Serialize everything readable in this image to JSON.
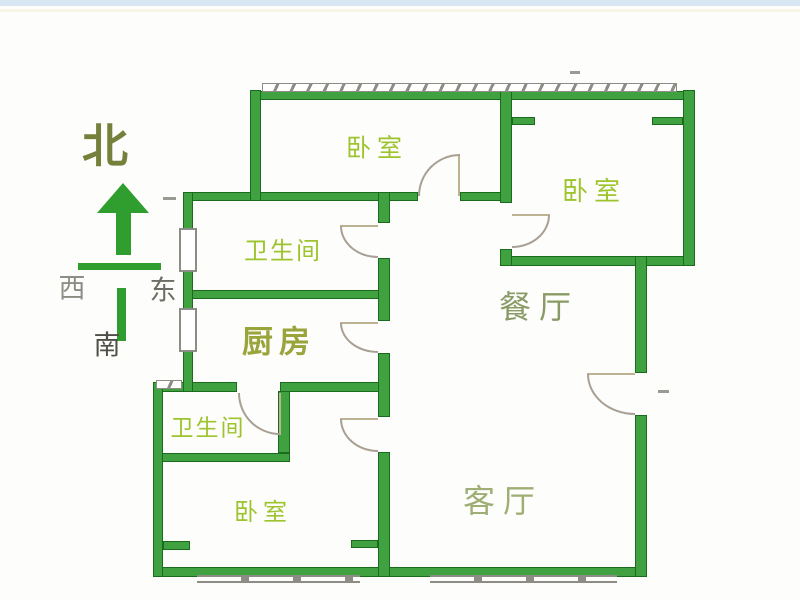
{
  "compass": {
    "north": "北",
    "west": "西",
    "east": "东",
    "south": "南"
  },
  "rooms": {
    "bedroom_top": {
      "label": "卧室"
    },
    "bedroom_right": {
      "label": "卧室"
    },
    "bedroom_bottom": {
      "label": "卧室"
    },
    "bathroom_upper": {
      "label": "卫生间"
    },
    "bathroom_lower": {
      "label": "卫生间"
    },
    "kitchen": {
      "label": "厨房"
    },
    "dining": {
      "label": "餐厅"
    },
    "living": {
      "label": "客厅"
    }
  },
  "colors": {
    "wall_green": "#3fa13f",
    "wall_border": "#1a6b1d",
    "door_leaf_tan": "#bdb292",
    "door_arc_gray": "#a8a094",
    "window_gray": "#8d8d85",
    "compass_arrow_green": "#2f9e2f",
    "label_bright_green": "#9dc42e",
    "label_olive": "#99a43b",
    "label_sage": "#8a9a66",
    "label_sage_light": "#9fae74",
    "north_olive": "#75803b",
    "west_gray": "#8d8d86",
    "east_gray": "#6e6e66",
    "south_gray": "#4f4f48"
  }
}
